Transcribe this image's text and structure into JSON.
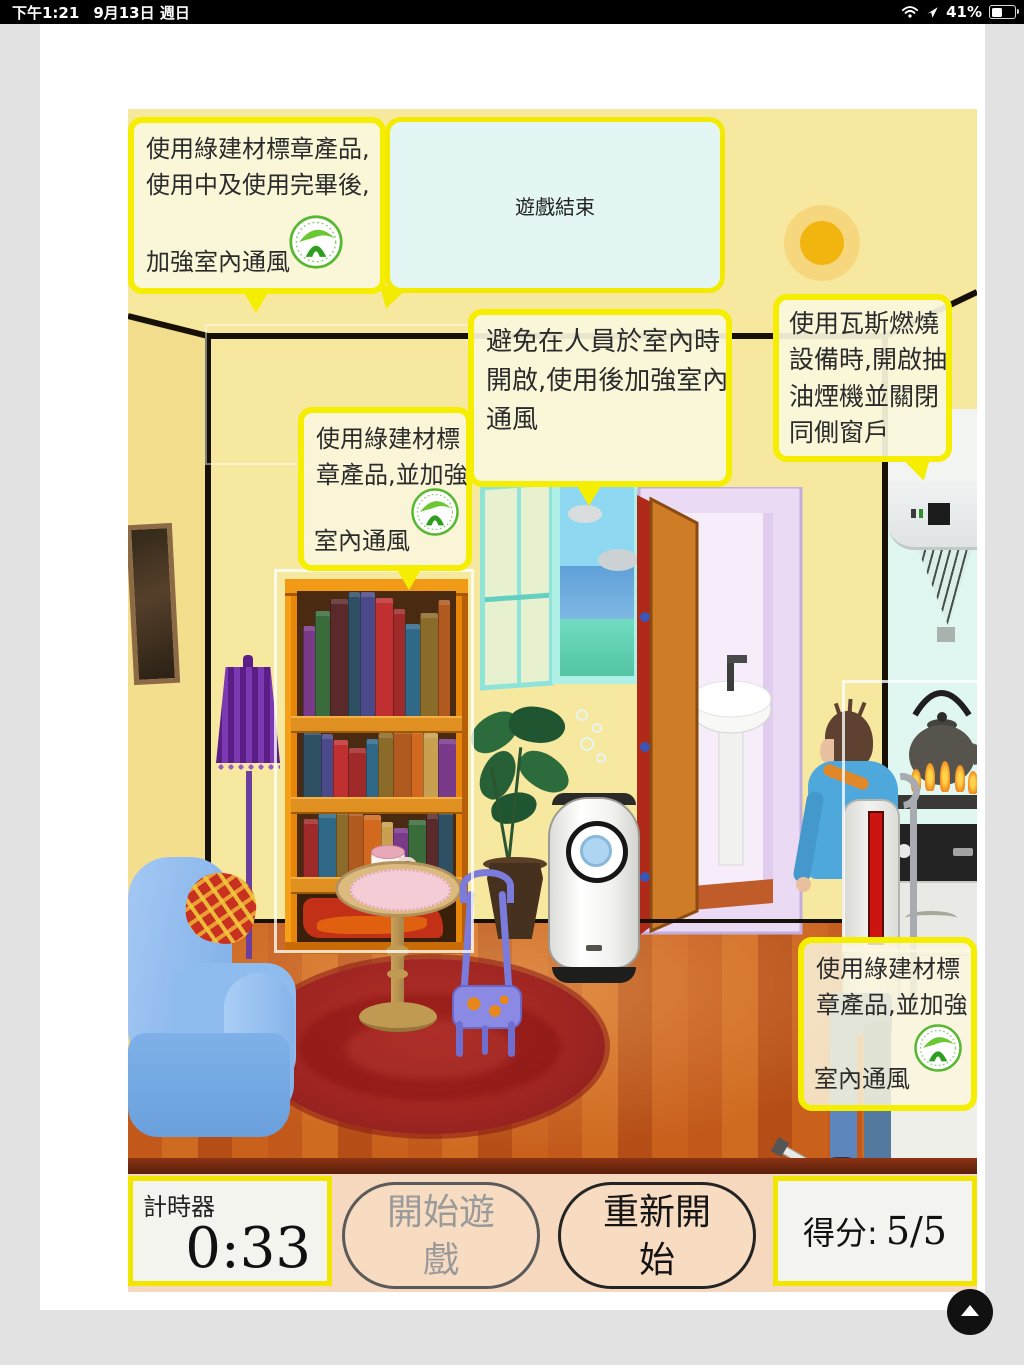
{
  "status_bar": {
    "time": "下午1:21",
    "date": "9月13日 週日",
    "battery_percent": "41%"
  },
  "dialog": {
    "text": "遊戲結束"
  },
  "tips": {
    "paint": {
      "line1": "使用綠建材標章產品,",
      "line2": "使用中及使用完畢後,",
      "line3": "加強室內通風"
    },
    "bookshelf": {
      "line1": "使用綠建材標",
      "line2": "章產品,並加強",
      "line3": "室內通風"
    },
    "window": {
      "line1": "避免在人員於室內時",
      "line2": "開啟,使用後加強室內",
      "line3": "通風"
    },
    "stove": {
      "line1": "使用瓦斯燃燒",
      "line2": "設備時,開啟抽",
      "line3": "油煙機並關閉",
      "line4": "同側窗戶"
    },
    "sprayer": {
      "line1": "使用綠建材標",
      "line2": "章產品,並加強",
      "line3": "室內通風"
    }
  },
  "hud": {
    "timer_label": "計時器",
    "timer_value": "0:33",
    "start_lines": [
      "開始遊",
      "戲"
    ],
    "restart_lines": [
      "重新開",
      "始"
    ],
    "score_label": "得分:",
    "score_value": "5/5"
  },
  "icons": {
    "wifi": "wifi-icon",
    "location": "location-arrow-icon",
    "battery": "battery-icon",
    "scroll_top": "scroll-to-top-icon",
    "green_label": "green-building-material-logo"
  },
  "colors": {
    "tip_border": "#f5ee00",
    "tip_bg": "#faf6dd",
    "dialog_bg": "#e3f6f3",
    "wall": "#f7e8a0",
    "hud_bar": "#f5d8be",
    "accent": "#f0e600",
    "floor": "#c2591b",
    "rug": "#a02622",
    "sofa": "#8fbcee"
  }
}
